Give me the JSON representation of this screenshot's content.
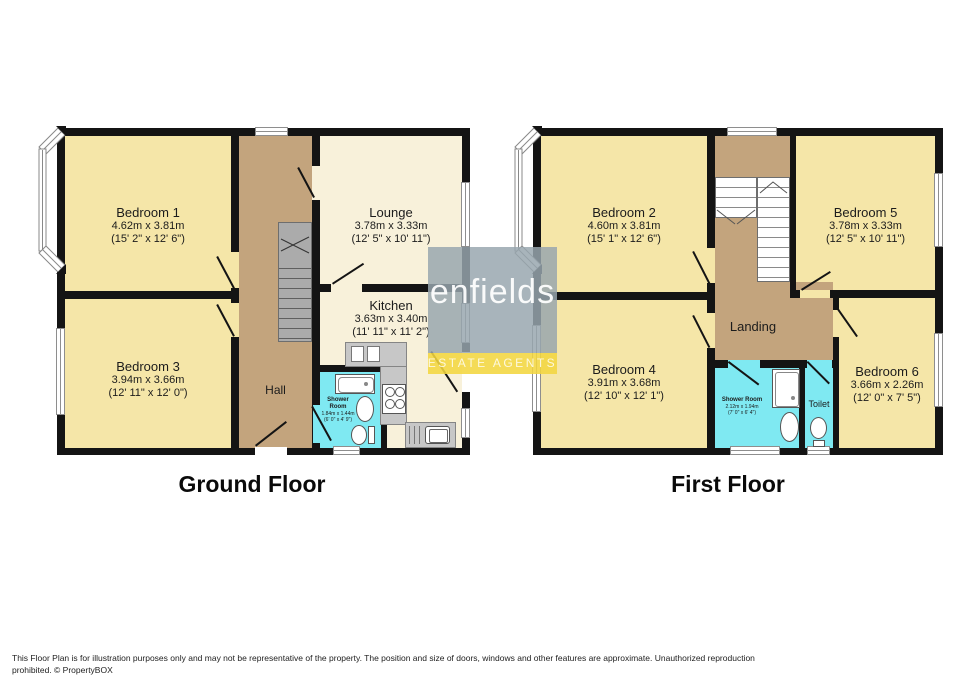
{
  "watermark": {
    "brand": "enfields",
    "tagline": "ESTATE AGENTS",
    "panel_color": "#97A6AE",
    "band_color": "#F3D640"
  },
  "colors": {
    "wall": "#141414",
    "bedroom_fill": "#F5E6A8",
    "living_fill": "#F8F1DA",
    "hall_fill": "#C3A47D",
    "wet_room_fill": "#7FE9F2",
    "stairs_gray": "#ABABAB"
  },
  "ground_floor": {
    "title": "Ground Floor",
    "rooms": {
      "bedroom1": {
        "name": "Bedroom 1",
        "metric": "4.62m x 3.81m",
        "imperial": "(15' 2\" x 12' 6\")"
      },
      "bedroom3": {
        "name": "Bedroom 3",
        "metric": "3.94m x 3.66m",
        "imperial": "(12' 11\" x 12' 0\")"
      },
      "lounge": {
        "name": "Lounge",
        "metric": "3.78m x 3.33m",
        "imperial": "(12' 5\" x 10' 11\")"
      },
      "kitchen": {
        "name": "Kitchen",
        "metric": "3.63m x 3.40m",
        "imperial": "(11' 11\" x 11' 2\")"
      },
      "hall": {
        "name": "Hall"
      },
      "shower_room": {
        "name": "Shower Room",
        "metric": "1.84m x 1.44m",
        "imperial": "(6' 0\" x 4' 9\")"
      }
    }
  },
  "first_floor": {
    "title": "First Floor",
    "rooms": {
      "bedroom2": {
        "name": "Bedroom 2",
        "metric": "4.60m x 3.81m",
        "imperial": "(15' 1\" x 12' 6\")"
      },
      "bedroom5": {
        "name": "Bedroom 5",
        "metric": "3.78m x 3.33m",
        "imperial": "(12' 5\" x 10' 11\")"
      },
      "bedroom4": {
        "name": "Bedroom 4",
        "metric": "3.91m x 3.68m",
        "imperial": "(12' 10\" x 12' 1\")"
      },
      "bedroom6": {
        "name": "Bedroom 6",
        "metric": "3.66m x 2.26m",
        "imperial": "(12' 0\" x 7' 5\")"
      },
      "landing": {
        "name": "Landing"
      },
      "shower_room": {
        "name": "Shower Room",
        "metric": "2.12m x 1.94m",
        "imperial": "(7' 0\" x 6' 4\")"
      },
      "toilet": {
        "name": "Toilet"
      }
    }
  },
  "footer": {
    "line1": "This Floor Plan is for illustration purposes only and may not be representative of the property. The position and size of doors, windows and other features are approximate. Unauthorized reproduction",
    "line2": "prohibited. © PropertyBOX"
  }
}
